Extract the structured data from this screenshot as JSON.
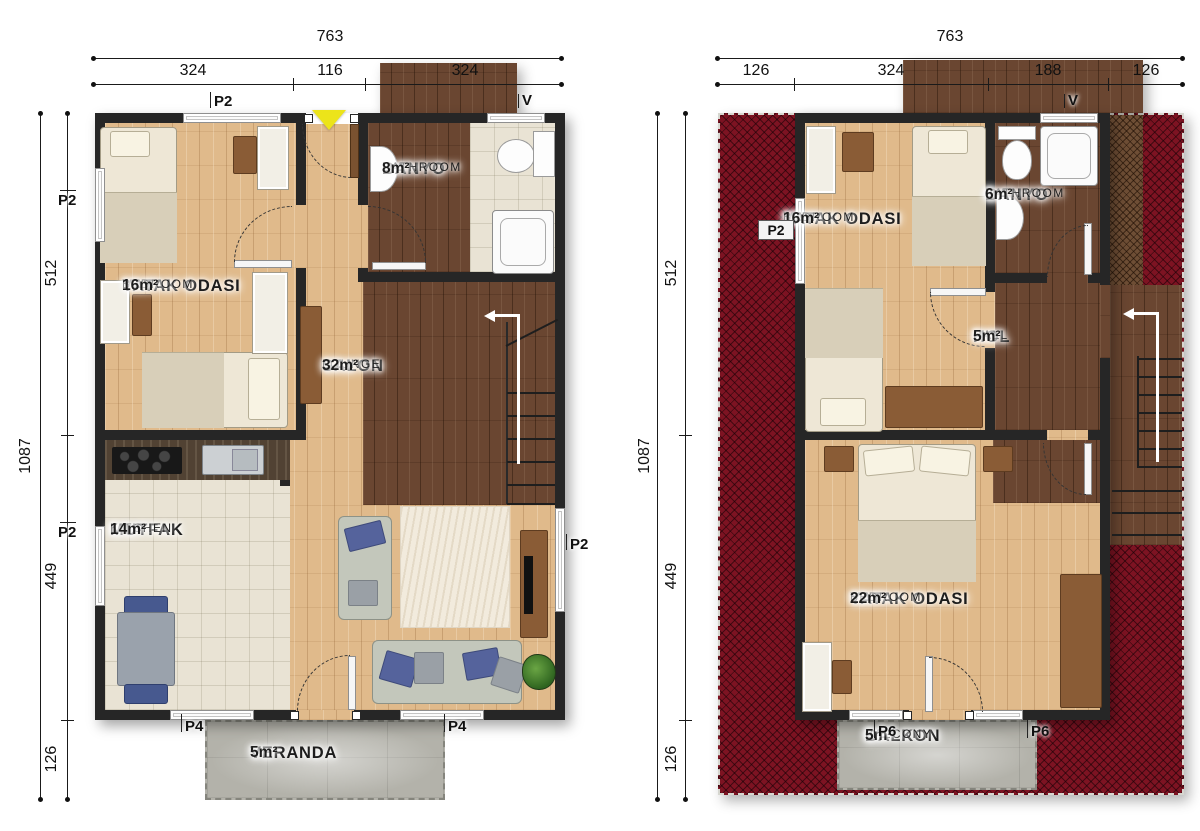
{
  "ground_floor": {
    "dims": {
      "top_total": "763",
      "top_segments": [
        "324",
        "116",
        "324"
      ],
      "side_total": "1087",
      "side_segments": [
        "512",
        "449",
        "126"
      ]
    },
    "rooms": {
      "bedroom": {
        "tr": "YATAK ODASI",
        "en": "BEDROOM",
        "area": "16m²"
      },
      "bathroom": {
        "tr": "BANYO",
        "en": "BATHROOM",
        "area": "8m²"
      },
      "lounge": {
        "tr": "SALON",
        "en": "LOUNGE",
        "area": "32m²"
      },
      "kitchen": {
        "tr": "MUTFAK",
        "en": "KITCHEN",
        "area": "14m²"
      },
      "veranda": {
        "tr": "VERANDA",
        "area": "5m²"
      }
    },
    "openings": {
      "top_window": "P2",
      "vent": "V",
      "left_window_1": "P2",
      "left_window_2": "P2",
      "right_window": "P2",
      "bottom_door_left": "P4",
      "bottom_door_right": "P4"
    }
  },
  "first_floor": {
    "dims": {
      "top_total": "763",
      "top_segments": [
        "126",
        "324",
        "188",
        "126"
      ],
      "side_total": "1087",
      "side_segments": [
        "512",
        "449",
        "126"
      ]
    },
    "rooms": {
      "bedroom_small": {
        "tr": "YATAK ODASI",
        "en": "BEDROOM",
        "area": "16m²"
      },
      "bathroom": {
        "tr": "BANYO",
        "en": "BATHROOM",
        "area": "6m²"
      },
      "hall": {
        "tr": "HOL",
        "en": "HALL",
        "area": "5m²"
      },
      "bedroom_large": {
        "tr": "YATAK ODASI",
        "en": "BEDROOM",
        "area": "22m²"
      },
      "balcony": {
        "tr": "BALKON",
        "en": "BALCONY",
        "area": "5m²"
      }
    },
    "openings": {
      "left_window": "P2",
      "vent": "V",
      "balcony_door_left": "P6",
      "balcony_door_right": "P6"
    }
  },
  "colors": {
    "roof": "#7d1322",
    "wall": "#262626",
    "wood_light": "#e0ba8b",
    "wood_dark": "#6a4631",
    "tile": "#e9e3d4",
    "deck": "#b3b2aa",
    "entry_arrow": "#ece41a"
  }
}
